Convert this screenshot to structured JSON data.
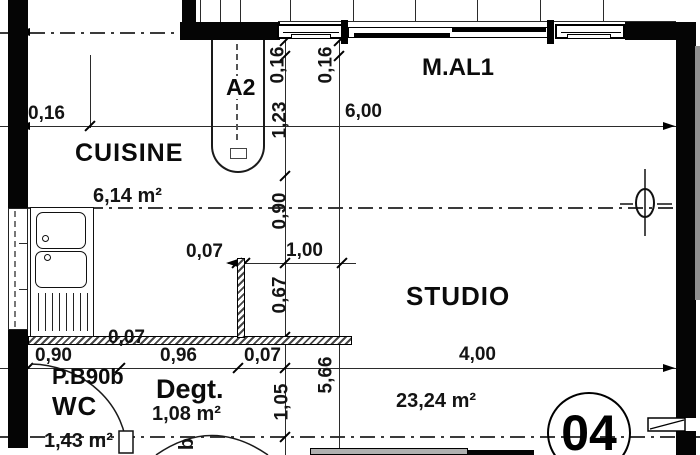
{
  "rooms": {
    "cuisine": {
      "name": "CUISINE",
      "area": "6,14 m²"
    },
    "studio": {
      "name": "STUDIO",
      "area": "23,24 m²"
    },
    "wc": {
      "name": "WC",
      "area": "1,43 m²"
    },
    "degagement": {
      "name": "Degt.",
      "area": "1,08 m²"
    }
  },
  "labels": {
    "window_top": "M.AL1",
    "door_a2": "A2",
    "door_wc": "P.B90b",
    "door_bottom_partial": "b",
    "unit_number": "04"
  },
  "dimensions": {
    "wall_thickness_left": "0,16",
    "total_width": "6,00",
    "v_wall_top_a": "0,16",
    "v_wall_top_b": "0,16",
    "v_door_a2": "1,23",
    "v_cuisine": "0,90",
    "v_opening_lower": "0,67",
    "v_degt": "1,05",
    "v_studio": "5,66",
    "h_partition_thickness": "0,07",
    "h_opening": "1,00",
    "h_wall_bottom_thickness": "0,07",
    "h_wc": "0,90",
    "h_degt": "0,96",
    "h_small": "0,07",
    "h_studio": "4,00"
  },
  "colors": {
    "ink": "#1a1a1a",
    "wall": "#050505",
    "hatch": "#474747",
    "furniture_gray": "#b0b0b0"
  }
}
